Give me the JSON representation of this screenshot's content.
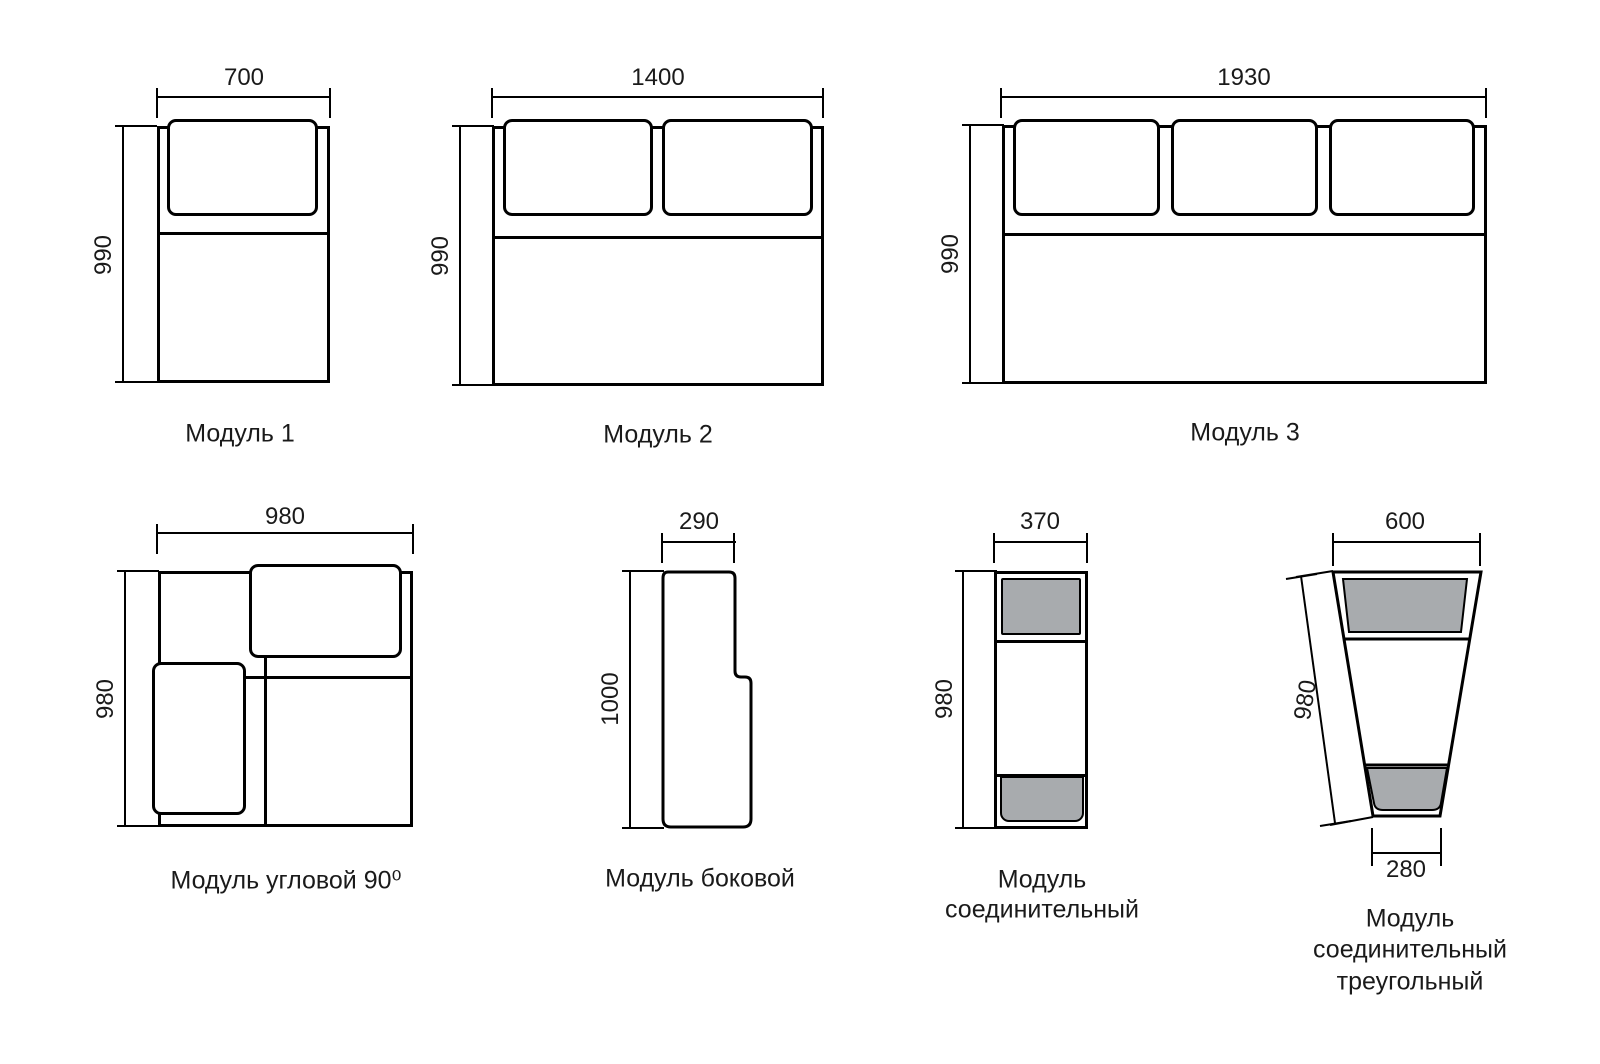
{
  "diagram": {
    "modules": {
      "m1": {
        "label": "Модуль 1",
        "width": "700",
        "height": "990"
      },
      "m2": {
        "label": "Модуль 2",
        "width": "1400",
        "height": "990"
      },
      "m3": {
        "label": "Модуль 3",
        "width": "1930",
        "height": "990"
      },
      "corner": {
        "label": "Модуль угловой 90⁰",
        "width": "980",
        "height": "980"
      },
      "side": {
        "label": "Модуль боковой",
        "width": "290",
        "height": "1000"
      },
      "conn": {
        "label_line1": "Модуль",
        "label_line2": "соединительный",
        "width": "370",
        "height": "980"
      },
      "tri": {
        "label_line1": "Модуль",
        "label_line2": "соединительный",
        "label_line3": "треугольный",
        "top_width": "600",
        "bottom_width": "280",
        "height": "980"
      }
    },
    "colors": {
      "line": "#000000",
      "cushion_fill": "#ffffff",
      "pad_gray": "#a8abae",
      "background": "#ffffff",
      "text": "#1a1a1a"
    }
  }
}
